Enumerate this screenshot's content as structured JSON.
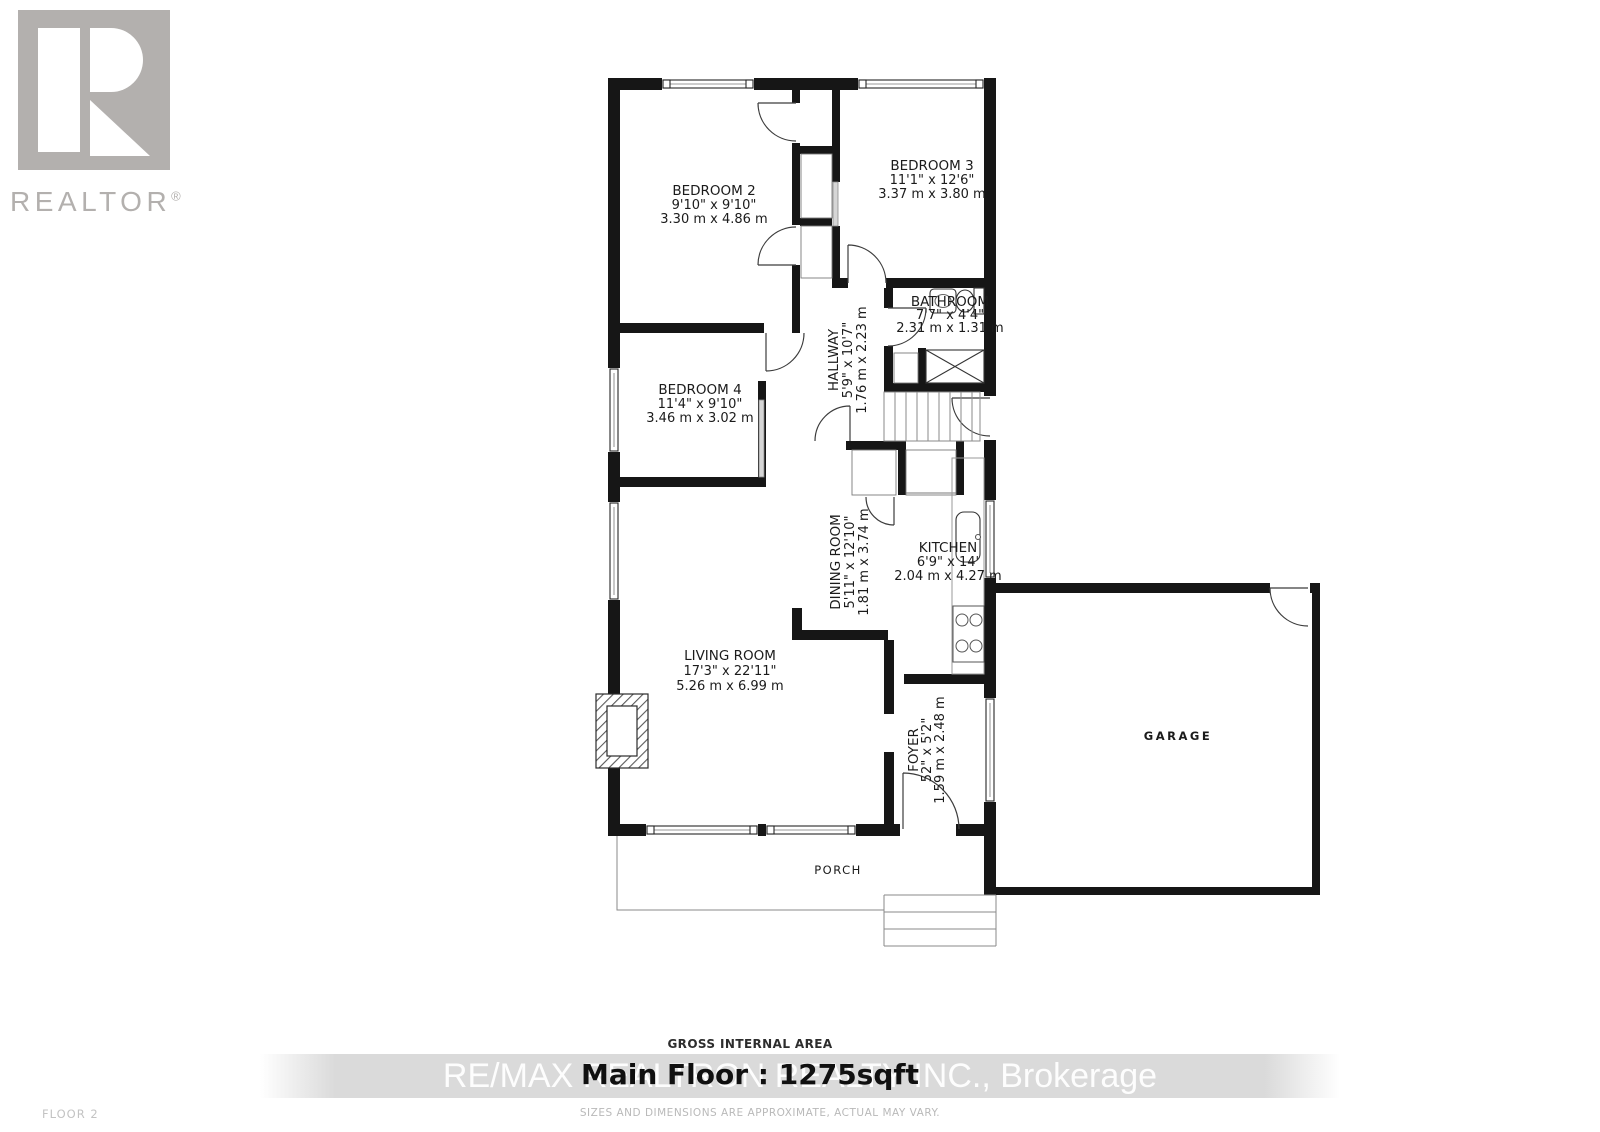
{
  "branding": {
    "logo_text": "REALTOR",
    "logo_registered": "®",
    "watermark_text": "RE/MAX REALTRON REALTY INC., Brokerage"
  },
  "rooms": {
    "bedroom2": {
      "name": "BEDROOM 2",
      "imperial": "9'10\" x 9'10\"",
      "metric": "3.30 m x 4.86 m"
    },
    "bedroom3": {
      "name": "BEDROOM 3",
      "imperial": "11'1\" x 12'6\"",
      "metric": "3.37 m x 3.80 m"
    },
    "bedroom4": {
      "name": "BEDROOM 4",
      "imperial": "11'4\" x 9'10\"",
      "metric": "3.46 m x 3.02 m"
    },
    "bathroom": {
      "name": "BATHROOM",
      "imperial": "7'7\" x 4'4\"",
      "metric": "2.31 m x 1.31 m"
    },
    "hallway": {
      "name": "HALLWAY",
      "imperial": "5'9\" x 10'7\"",
      "metric": "1.76 m x 2.23 m"
    },
    "dining_room": {
      "name": "DINING ROOM",
      "imperial": "5'11\" x 12'10\"",
      "metric": "1.81 m x 3.74 m"
    },
    "kitchen": {
      "name": "KITCHEN",
      "imperial": "6'9\" x 14'",
      "metric": "2.04 m x 4.27 m"
    },
    "living_room": {
      "name": "LIVING ROOM",
      "imperial": "17'3\" x 22'11\"",
      "metric": "5.26 m x 6.99 m"
    },
    "foyer": {
      "name": "FOYER",
      "imperial": "52\" x 5'2\"",
      "metric": "1.59 m x 2.48 m"
    },
    "garage": {
      "name": "GARAGE"
    },
    "porch": {
      "name": "PORCH"
    }
  },
  "footer": {
    "gross_internal_area": "GROSS INTERNAL AREA",
    "floor_title": "Main Floor : 1275sqft",
    "disclaimer": "SIZES AND DIMENSIONS ARE APPROXIMATE, ACTUAL MAY VARY.",
    "floor_label": "FLOOR 2"
  },
  "colors": {
    "wall": "#161616",
    "label_text": "#1b1b1b",
    "logo_gray": "#b3b0ae",
    "watermark_band": "#d8d8d8",
    "watermark_text": "#fdfdfd",
    "muted_text": "#b9b9b9"
  }
}
